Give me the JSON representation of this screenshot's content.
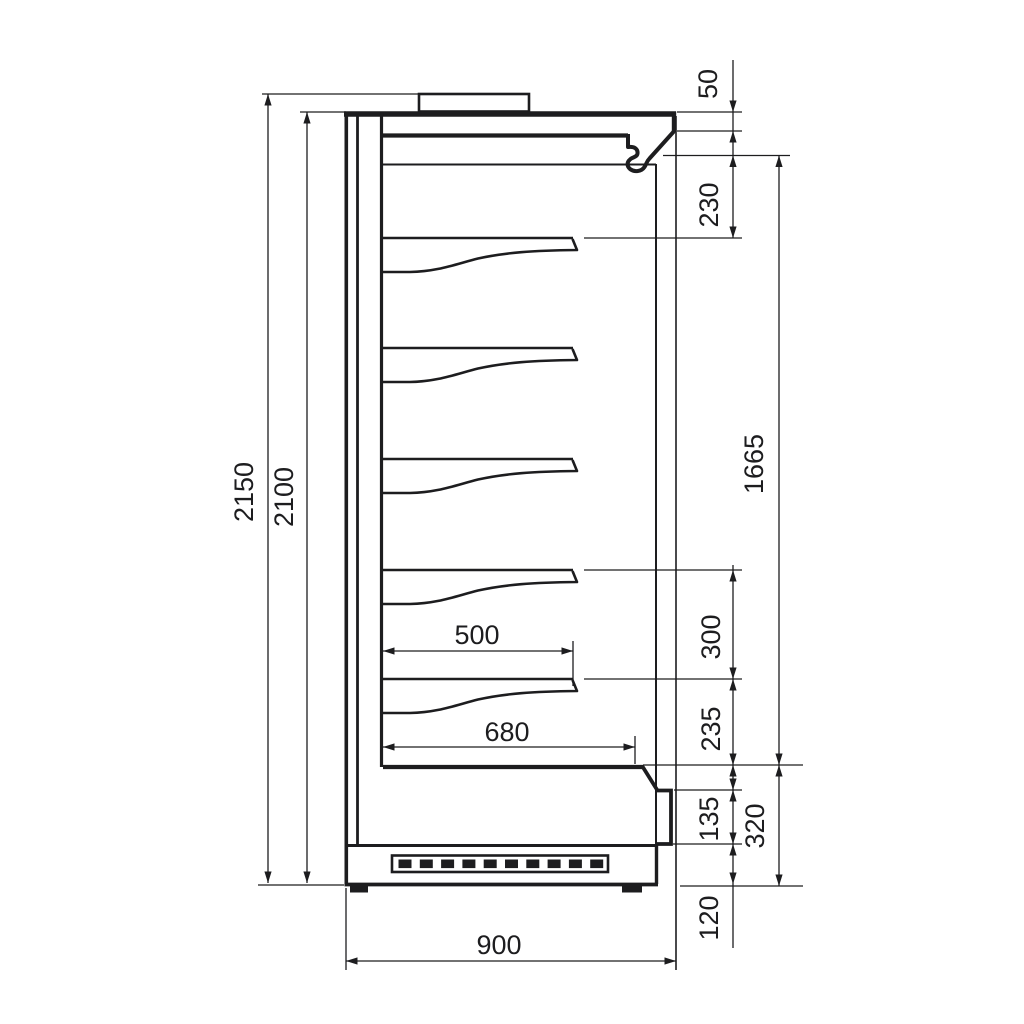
{
  "drawing": {
    "type": "technical-dimension-drawing",
    "subject": "refrigerated multideck display cabinet, side section view",
    "units": "mm",
    "line_color": "#1d1d1f",
    "background": "#ffffff",
    "shelf_count": 5,
    "dimensions": {
      "overall_height": "2150",
      "cabinet_height": "2100",
      "canopy_front_height": "50",
      "canopy_to_first_shelf": "230",
      "display_opening_height": "1665",
      "shelf_spacing": "300",
      "last_shelf_to_deck": "235",
      "lower_front_panel": "135",
      "base_section_height": "320",
      "plinth_height": "120",
      "shelf_depth": "500",
      "deck_depth": "680",
      "overall_depth": "900"
    }
  }
}
